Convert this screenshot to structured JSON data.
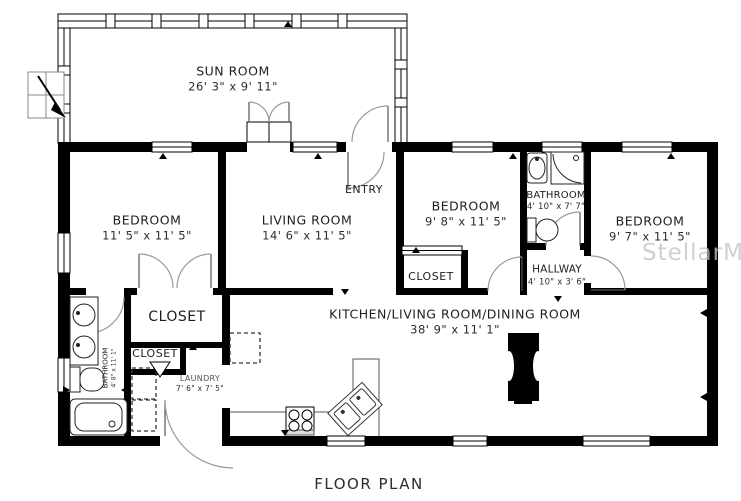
{
  "title": "FLOOR PLAN",
  "watermark": "StellarMLS",
  "rooms": {
    "sun_room": {
      "name": "SUN ROOM",
      "dims": "26' 3\" x 9' 11\""
    },
    "entry": {
      "name": "ENTRY"
    },
    "bedroom_left": {
      "name": "BEDROOM",
      "dims": "11' 5\" x 11' 5\""
    },
    "living_room": {
      "name": "LIVING ROOM",
      "dims": "14' 6\" x 11' 5\""
    },
    "bedroom_middle": {
      "name": "BEDROOM",
      "dims": "9' 8\" x 11' 5\""
    },
    "bathroom_hall": {
      "name": "BATHROOM",
      "dims": "4' 10\" x 7' 7\""
    },
    "bedroom_right": {
      "name": "BEDROOM",
      "dims": "9' 7\" x 11' 5\""
    },
    "closet_bedroom_middle": {
      "name": "CLOSET"
    },
    "hallway": {
      "name": "HALLWAY",
      "dims": "4' 10\" x 3' 6\""
    },
    "kitchen_living_dining": {
      "name": "KITCHEN/LIVING ROOM/DINING ROOM",
      "dims": "38' 9\" x 11' 1\""
    },
    "closet_large": {
      "name": "CLOSET"
    },
    "closet_small": {
      "name": "CLOSET"
    },
    "bathroom_primary": {
      "name": "BATHROOM",
      "dims": "4' 8\" x 11' 1\""
    },
    "laundry": {
      "name": "LAUNDRY",
      "dims": "7' 6\" x 7' 5\""
    }
  },
  "colors": {
    "walls": "#000000",
    "door_swing": "#9a9a9a",
    "watermark": "#c5c5c5",
    "label_text": "#1e1e1e"
  }
}
